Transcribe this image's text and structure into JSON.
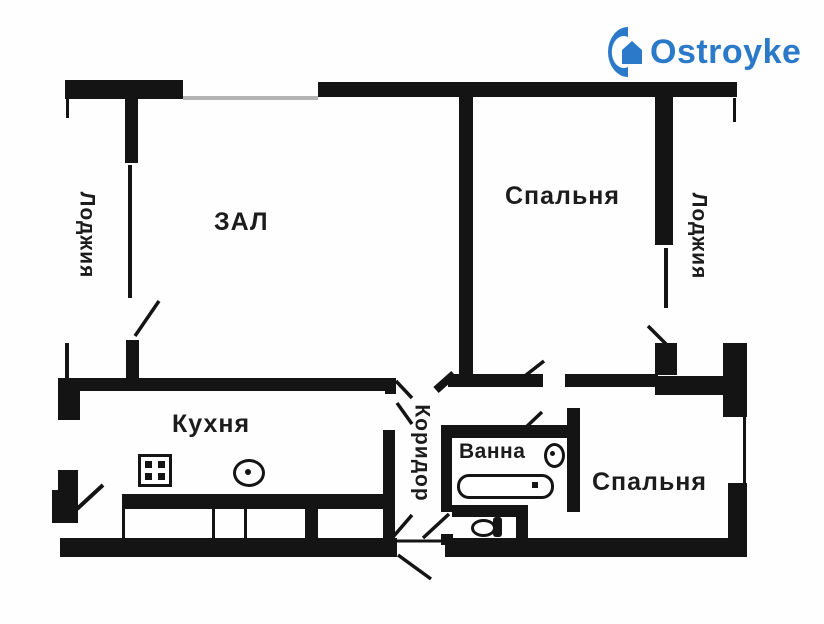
{
  "logo": {
    "text": "Ostroyke",
    "icon": "house-logo-icon",
    "color": "#2b7ac9"
  },
  "rooms": {
    "zal": "ЗАЛ",
    "bedroom_top": "Спальня",
    "bedroom_bottom": "Спальня",
    "kitchen": "Кухня",
    "bath": "Ванна",
    "corridor": "Коридор",
    "loggia_left": "Лоджия",
    "loggia_right": "Лоджия"
  },
  "icons": {
    "stove": "four-burner-stove-icon",
    "kitchen_sink": "round-sink-icon",
    "bath_sink": "oval-sink-icon",
    "bathtub": "bathtub-icon",
    "toilet": "toilet-icon"
  },
  "colors": {
    "wall": "#141414",
    "text": "#1c1c1c",
    "window_line": "#b3b3b3",
    "logo_blue": "#2b7ac9"
  }
}
